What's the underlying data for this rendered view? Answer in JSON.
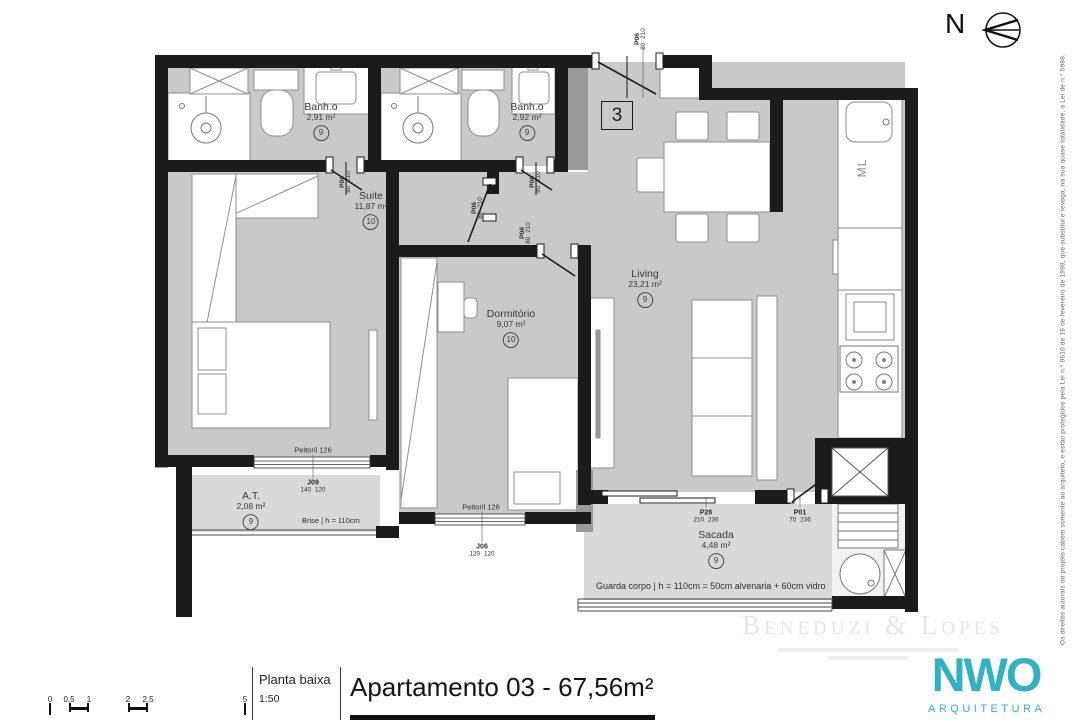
{
  "north_label": "N",
  "unit_badge": "3",
  "rooms": {
    "banho1": {
      "name": "Banh.o",
      "area": "2,91 m²",
      "finish_code": "9"
    },
    "banho2": {
      "name": "Banh.o",
      "area": "2,92 m²",
      "finish_code": "9"
    },
    "suite": {
      "name": "Suite",
      "area": "11,87 m²",
      "finish_code": "10"
    },
    "dormitorio": {
      "name": "Dormitório",
      "area": "9,07 m²",
      "finish_code": "10"
    },
    "living": {
      "name": "Living",
      "area": "23,21 m²",
      "finish_code": "9"
    },
    "area_tecnica": {
      "name": "A.T.",
      "area": "2,08 m²",
      "finish_code": "9"
    },
    "sacada": {
      "name": "Sacada",
      "area": "4,48 m²",
      "finish_code": "9"
    }
  },
  "doors": {
    "entry": {
      "code": "P06",
      "w": "80",
      "h": "210"
    },
    "banho1": {
      "code": "P06",
      "w": "80",
      "h": "210"
    },
    "banho2": {
      "code": "P06",
      "w": "80",
      "h": "210"
    },
    "hall": {
      "code": "P06",
      "w": "80",
      "h": "210"
    },
    "dormitorio": {
      "code": "P06",
      "w": "80",
      "h": "210"
    },
    "sacada": {
      "code": "P26",
      "w": "210",
      "h": "236"
    },
    "servico": {
      "code": "P01",
      "w": "70",
      "h": "236"
    }
  },
  "windows": {
    "j09": {
      "code": "J09",
      "w": "140",
      "h": "120",
      "sill": "Peitoril 126"
    },
    "j06": {
      "code": "J06",
      "w": "120",
      "h": "120",
      "sill": "Peitoril 126"
    }
  },
  "annotations": {
    "brise": "Brise | h = 110cm",
    "guarda_corpo": "Guarda corpo | h = 110cm = 50cm alvenaria + 60cm vidro",
    "ml": "ML"
  },
  "title_block": {
    "drawing_type": "Planta baixa",
    "scale": "1:50",
    "title": "Apartamento 03 - 67,56m²",
    "scale_bar_ticks": [
      "0",
      "0,5",
      "1",
      "2",
      "2,5",
      "5"
    ]
  },
  "branding": {
    "watermark": "Beneduzi & Lopes",
    "studio": "NWO",
    "studio_sub": "ARQUITETURA",
    "accent_color": "#2fb2c4"
  },
  "copyright": "Os direitos autorais do projeto cabem somente ao arquiteto, e estão protegidos pela Lei n.° 9610 de 19 de fevereiro de 1998, que substitui e revoga, na sua quase totalidade, a Lei de n.° 5988."
}
